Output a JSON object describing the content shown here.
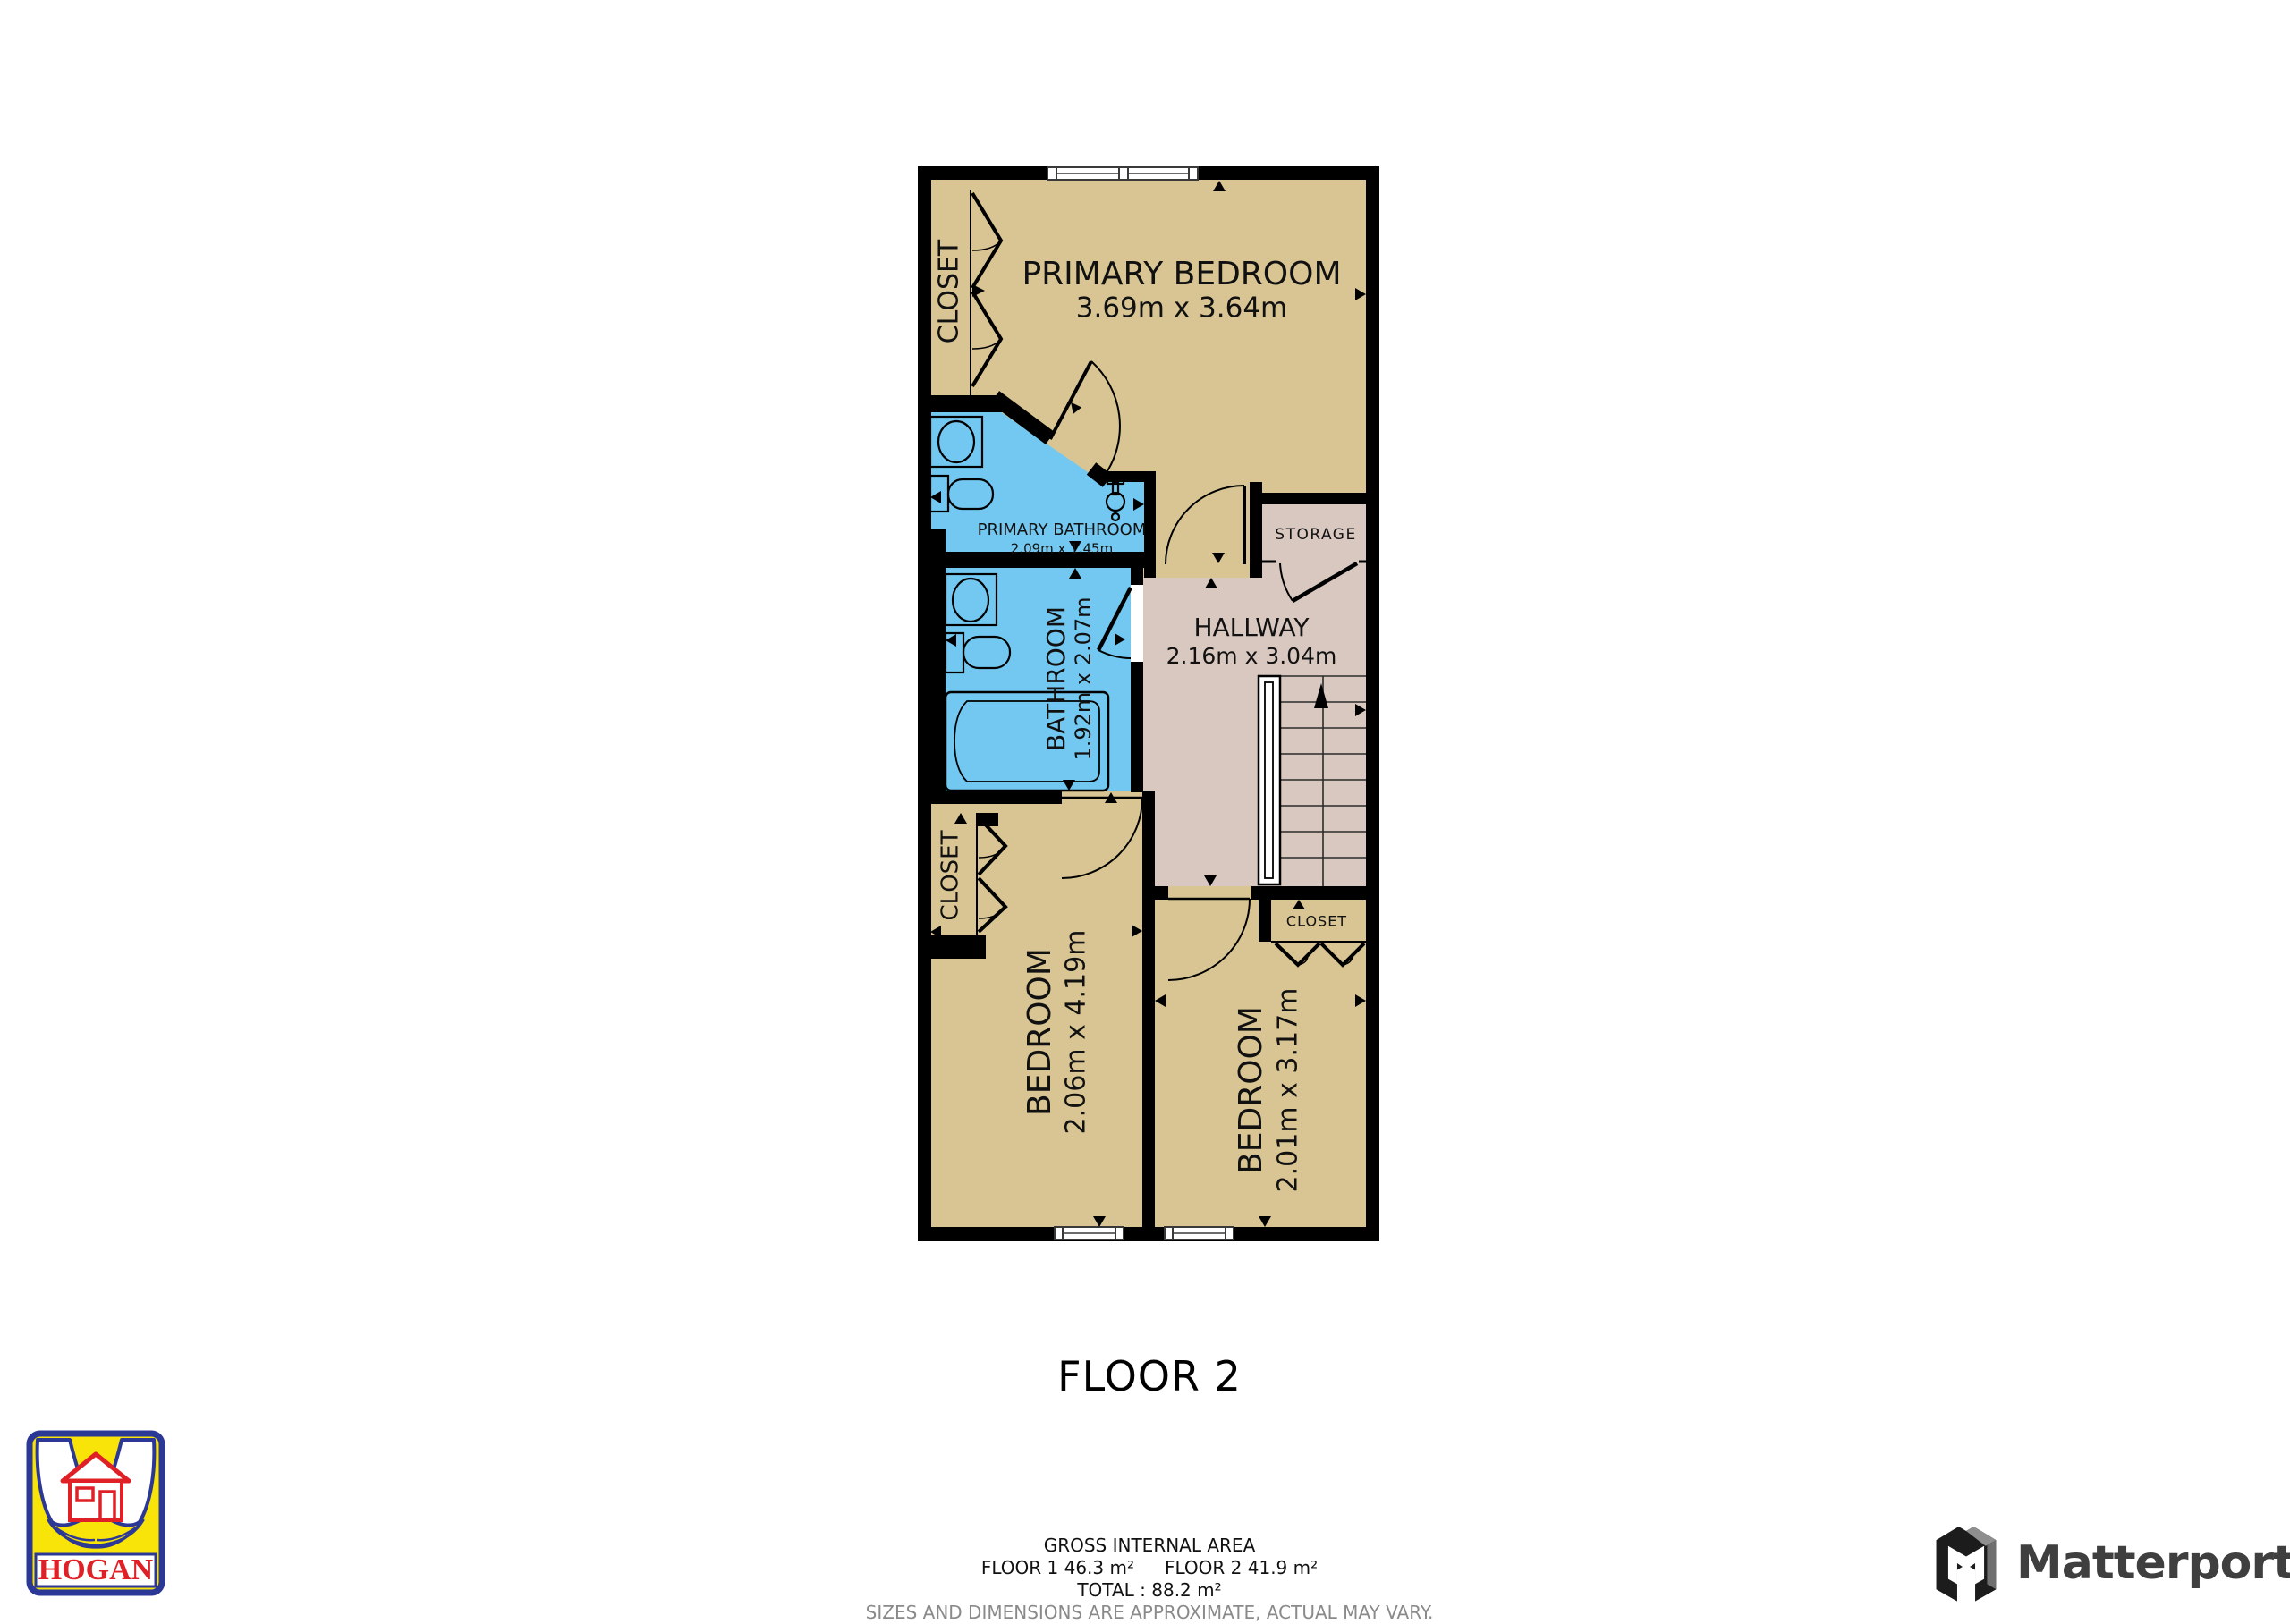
{
  "plan": {
    "floor_title": "FLOOR 2",
    "rooms": {
      "primary_bedroom": {
        "label": "PRIMARY BEDROOM",
        "dims": "3.69m x 3.64m"
      },
      "primary_bathroom": {
        "label": "PRIMARY BATHROOM",
        "dims": "2.09m x 1.45m"
      },
      "bathroom": {
        "label": "BATHROOM",
        "dims": "1.92m x 2.07m"
      },
      "hallway": {
        "label": "HALLWAY",
        "dims": "2.16m x 3.04m"
      },
      "storage": {
        "label": "STORAGE"
      },
      "bedroom_left": {
        "label": "BEDROOM",
        "dims": "2.06m x 4.19m"
      },
      "bedroom_right": {
        "label": "BEDROOM",
        "dims": "2.01m x 3.17m"
      },
      "closet_primary": {
        "label": "CLOSET"
      },
      "closet_left": {
        "label": "CLOSET"
      },
      "closet_right": {
        "label": "CLOSET"
      }
    }
  },
  "footer": {
    "gross_internal_area": "GROSS INTERNAL AREA",
    "floor1_area": "FLOOR 1 46.3 m²",
    "floor2_area": "FLOOR 2 41.9 m²",
    "total_area": "TOTAL :  88.2 m²",
    "disclaimer": "SIZES AND DIMENSIONS ARE APPROXIMATE, ACTUAL MAY VARY."
  },
  "branding": {
    "hogan_label": "HOGAN",
    "matterport_label": "Matterport"
  },
  "colors": {
    "floor_tan": "#d8c593",
    "bathroom_blue": "#72c8f0",
    "hallway_pink": "#d9c8c0",
    "wall_black": "#000000",
    "hogan_yellow": "#f8e408",
    "hogan_blue": "#2c3896",
    "hogan_red": "#df2127",
    "matterport_dark": "#3f3f3f",
    "disclaimer_gray": "#8a8a8a"
  }
}
